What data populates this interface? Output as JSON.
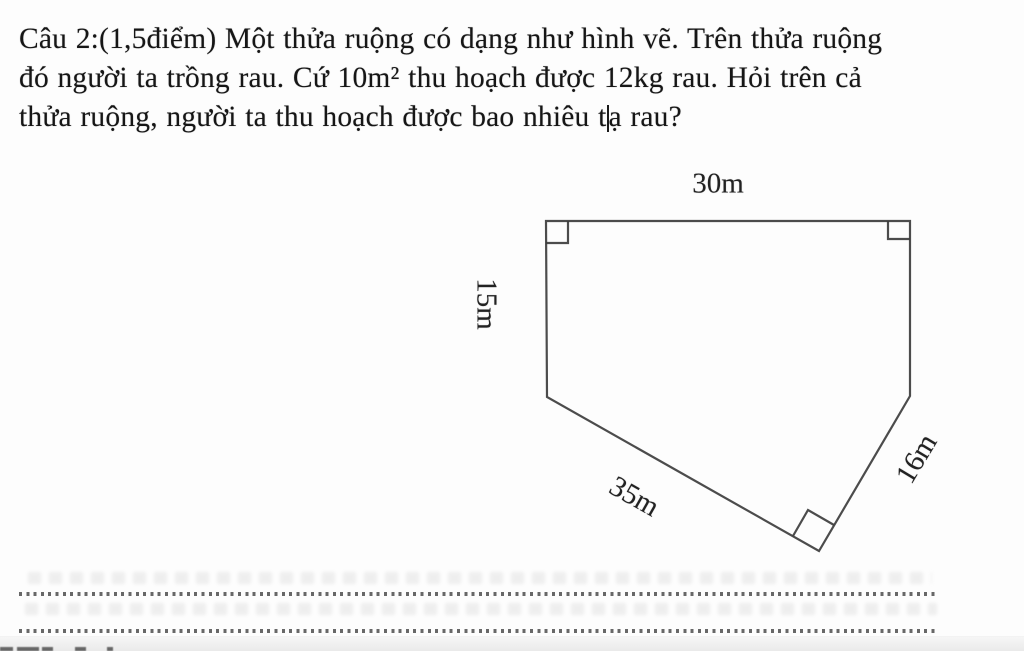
{
  "problem": {
    "line1": "Câu 2:(1,5điểm) Một thửa ruộng có dạng như hình vẽ. Trên thửa ruộng",
    "line2": "đó người ta trồng rau. Cứ 10m² thu hoạch được 12kg rau. Hỏi trên cả",
    "line3_before_caret": "thửa ruộng, người ta thu hoạch được bao nhiêu t",
    "line3_after_caret": "ạ rau?"
  },
  "figure": {
    "shape": "pentagon-field",
    "labels": {
      "top": "30m",
      "left": "15m",
      "bottom": "35m",
      "right": "16m"
    },
    "right_angle_marks": 3
  },
  "answer_area": {
    "dotted_lines": 2
  },
  "colors": {
    "paper": "#fdfdfd",
    "ink": "#161616",
    "figure_line": "#3d3d3d",
    "dotted_line": "#4d4d4d",
    "page_edge_strip": "#ececec"
  }
}
